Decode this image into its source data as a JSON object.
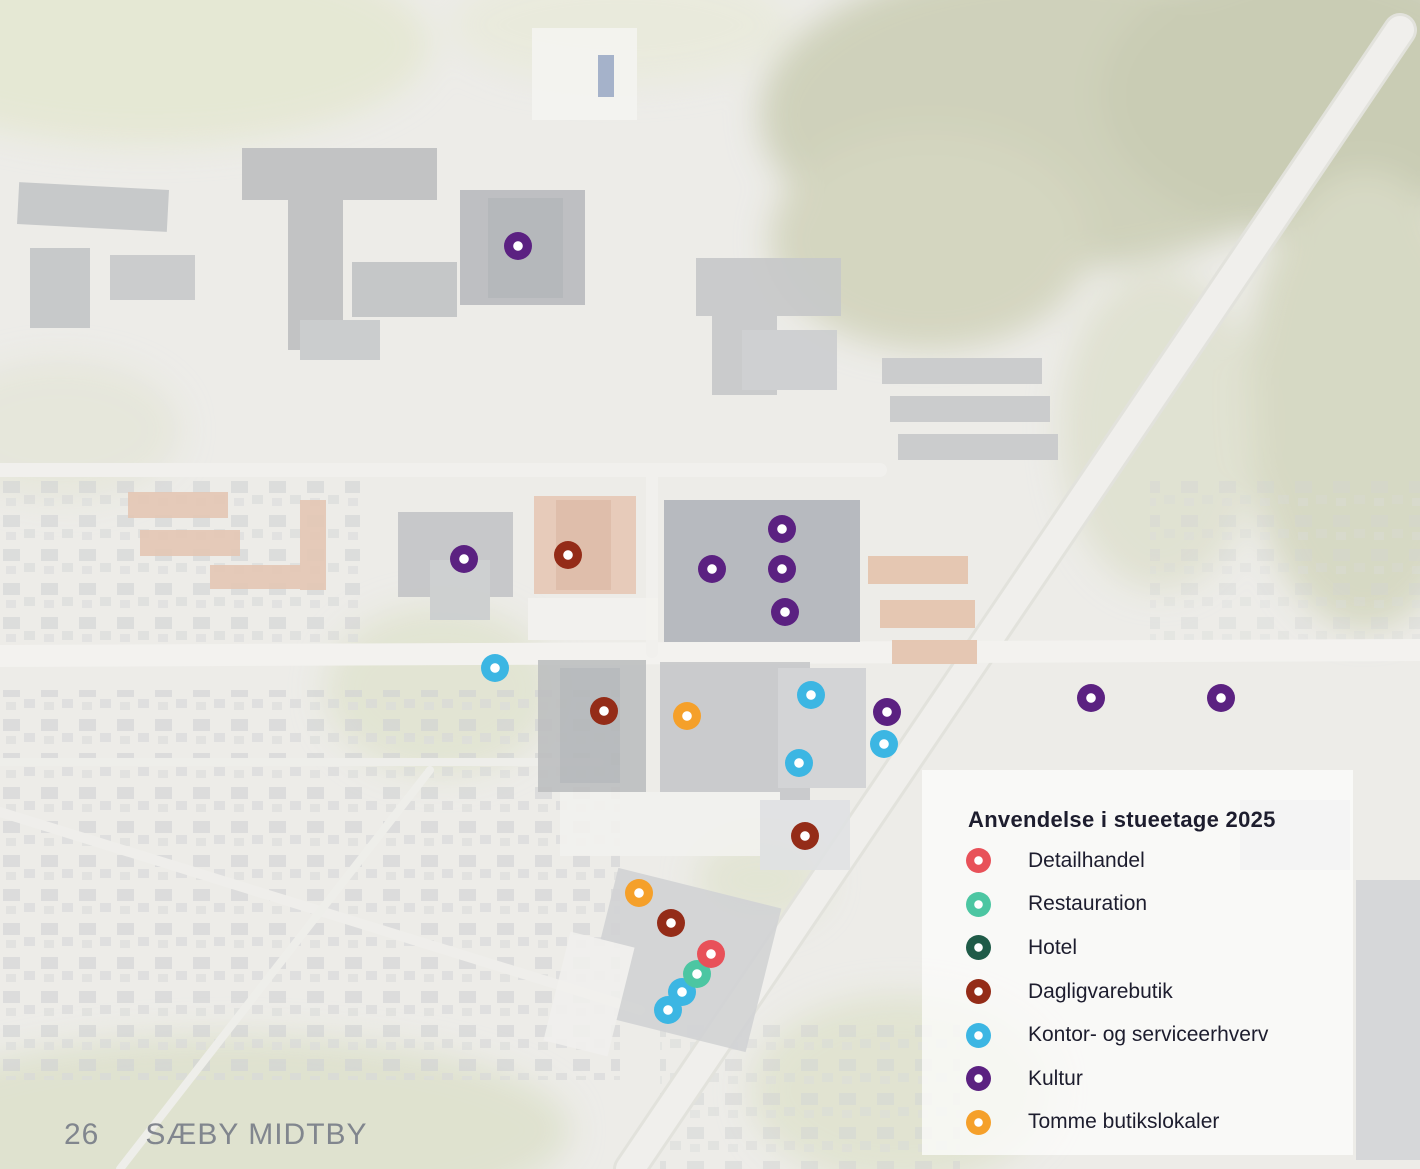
{
  "footer": {
    "page_number": "26",
    "title": "SÆBY MIDTBY"
  },
  "legend": {
    "title": "Anvendelse i stueetage 2025",
    "items": [
      {
        "key": "detailhandel",
        "label": "Detailhandel",
        "color": "#e85159"
      },
      {
        "key": "restauration",
        "label": "Restauration",
        "color": "#4cc6a2"
      },
      {
        "key": "hotel",
        "label": "Hotel",
        "color": "#1f5b48"
      },
      {
        "key": "dagligvarebutik",
        "label": "Dagligvarebutik",
        "color": "#942c18"
      },
      {
        "key": "kontor-service",
        "label": "Kontor- og serviceerhverv",
        "color": "#3cb6e3"
      },
      {
        "key": "kultur",
        "label": "Kultur",
        "color": "#5b2181"
      },
      {
        "key": "tomme",
        "label": "Tomme butikslokaler",
        "color": "#f5a02a"
      }
    ]
  },
  "map": {
    "markers": [
      {
        "category": "kultur",
        "x": 518,
        "y": 246
      },
      {
        "category": "kultur",
        "x": 464,
        "y": 559
      },
      {
        "category": "dagligvarebutik",
        "x": 568,
        "y": 555
      },
      {
        "category": "kultur",
        "x": 712,
        "y": 569
      },
      {
        "category": "kultur",
        "x": 782,
        "y": 529
      },
      {
        "category": "kultur",
        "x": 782,
        "y": 569
      },
      {
        "category": "kultur",
        "x": 785,
        "y": 612
      },
      {
        "category": "kontor-service",
        "x": 495,
        "y": 668
      },
      {
        "category": "dagligvarebutik",
        "x": 604,
        "y": 711
      },
      {
        "category": "tomme",
        "x": 687,
        "y": 716
      },
      {
        "category": "kontor-service",
        "x": 811,
        "y": 695
      },
      {
        "category": "kultur",
        "x": 887,
        "y": 712
      },
      {
        "category": "kontor-service",
        "x": 884,
        "y": 744
      },
      {
        "category": "kontor-service",
        "x": 799,
        "y": 763
      },
      {
        "category": "kultur",
        "x": 1091,
        "y": 698
      },
      {
        "category": "kultur",
        "x": 1221,
        "y": 698
      },
      {
        "category": "dagligvarebutik",
        "x": 805,
        "y": 836
      },
      {
        "category": "tomme",
        "x": 639,
        "y": 893
      },
      {
        "category": "dagligvarebutik",
        "x": 671,
        "y": 923
      },
      {
        "category": "kontor-service",
        "x": 668,
        "y": 1010
      },
      {
        "category": "kontor-service",
        "x": 682,
        "y": 992
      },
      {
        "category": "restauration",
        "x": 697,
        "y": 974
      },
      {
        "category": "detailhandel",
        "x": 711,
        "y": 954
      }
    ]
  }
}
